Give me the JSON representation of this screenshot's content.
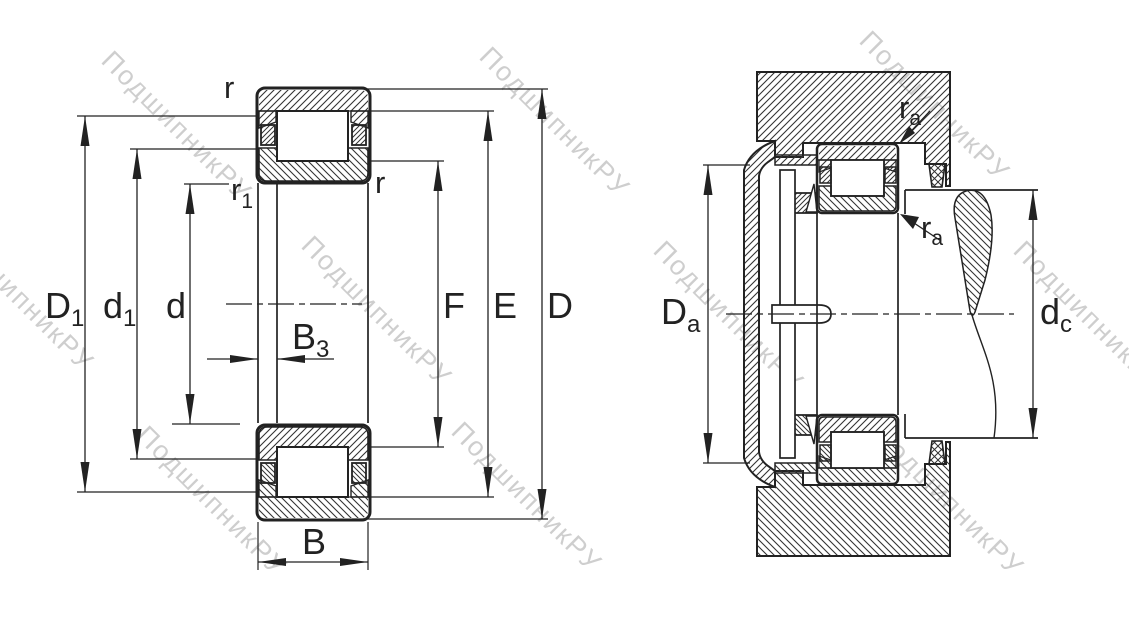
{
  "document": {
    "type": "bearing-technical-drawing",
    "description": "Cylindrical roller bearing cross-section and mounting arrangement drawing"
  },
  "colors": {
    "line": "#222222",
    "hatch": "#333333",
    "background": "#ffffff",
    "watermark": "#9e9e9e"
  },
  "watermark": {
    "text": "ПодшипникРУ"
  },
  "left_view": {
    "name": "bearing-cross-section",
    "labels": {
      "D1": {
        "base": "D",
        "sub": "1"
      },
      "d1": {
        "base": "d",
        "sub": "1"
      },
      "d": {
        "base": "d"
      },
      "B3": {
        "base": "B",
        "sub": "3"
      },
      "B": {
        "base": "B"
      },
      "F": {
        "base": "F"
      },
      "E": {
        "base": "E"
      },
      "D": {
        "base": "D"
      },
      "r_top": {
        "base": "r"
      },
      "r_inner": {
        "base": "r"
      },
      "r1": {
        "base": "r",
        "sub": "1"
      }
    }
  },
  "right_view": {
    "name": "bearing-mounting-arrangement",
    "labels": {
      "Da": {
        "base": "D",
        "sub": "a"
      },
      "dc": {
        "base": "d",
        "sub": "c"
      },
      "ra_top": {
        "base": "r",
        "sub": "a"
      },
      "ra_bottom": {
        "base": "r",
        "sub": "a"
      }
    }
  }
}
